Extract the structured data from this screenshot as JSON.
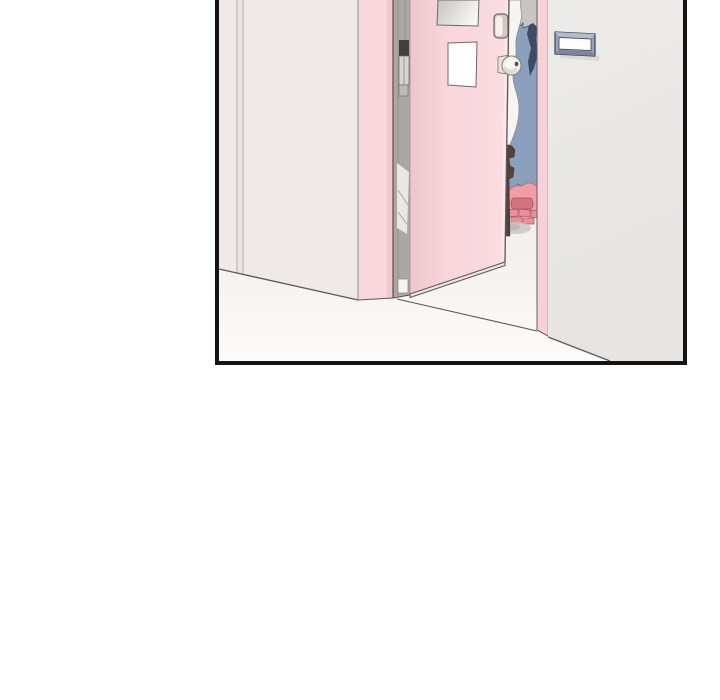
{
  "panel": {
    "type": "comic-panel",
    "border_color": "#141414",
    "page_background": "#ffffff"
  },
  "scene": {
    "objects": [
      "hallway left wall with seam",
      "pink door frame jamb",
      "door hinge edge strip with hinges",
      "open pink door",
      "frosted upper door window",
      "clear lower door window",
      "door latch plate",
      "round door knob",
      "figure in blue seen through door gap",
      "white fabric fold",
      "dark brown strap",
      "pink slippers on step blocks",
      "floor shadow",
      "right pink jamb strip",
      "right hallway wall",
      "blank door name plate",
      "white hallway floor"
    ]
  },
  "palette": {
    "left_wall": "#efe9e8",
    "left_wall_light": "#f3eeec",
    "left_wall_shade": "#ebe5e4",
    "wall_seam": "#b3acaa",
    "seam_fill": "#eae4e3",
    "outline": "#5f5755",
    "floor_dark": "#f4f0ee",
    "floor_light": "#fdfcfb",
    "door_frame_pink": "#f8d8dd",
    "door_frame_pink_shade": "#f3c9d0",
    "door_pink": "#f7d5db",
    "door_pink_shade": "#eec5cd",
    "door_pink_light": "#fadde2",
    "door_highlight": "#fce9ed",
    "door_bottom_face": "#eae6e3",
    "door_edge_strip": "#aca7a5",
    "hinge_dark": "#453f3c",
    "hinge_metal": "#d7d3d0",
    "hinge_small": "#bfbab7",
    "hinge_white_patch": "#e9e6e4",
    "door_stop_white": "#f6f4f2",
    "window_glass_gray": "#c6c3c1",
    "window_white": "#fefefe",
    "window_outline": "#6e6965",
    "lock_plate": "#d2c9c0",
    "lock_plate_light": "#f4f0ea",
    "knob_cream": "#f1eee8",
    "knob_inner": "#f8f6f2",
    "knob_shade": "#cdc7bf",
    "knob_stem": "#e6e2dc",
    "knob_dot": "#564f49",
    "interior_wall_gray": "#c8c5c3",
    "figure_blue": "#8ba0bc",
    "figure_navy": "#3f4968",
    "figure_white": "#f6f5f3",
    "strap_brown": "#54403d",
    "slipper_pink": "#f09da5",
    "slipper_dark": "#d4737f",
    "slipper_brick": "#ec8f98",
    "slipper_brick_outline": "#9e5a64",
    "shadow_gray": "#c9c6c3",
    "shadow_gray_dark": "#bab7b4",
    "right_jamb_pink": "#f6d2d8",
    "right_wall": "#edebe9",
    "right_wall_shade": "#e7e4e2",
    "nameplate_frame": "#9aa2b6",
    "nameplate_frame_light": "#b7bccb",
    "nameplate_frame_dark": "#7d86a0",
    "nameplate_outline": "#3c4260",
    "nameplate_inner": "#fdfdfd",
    "nameplate_shadow": "#d9d6d3"
  }
}
